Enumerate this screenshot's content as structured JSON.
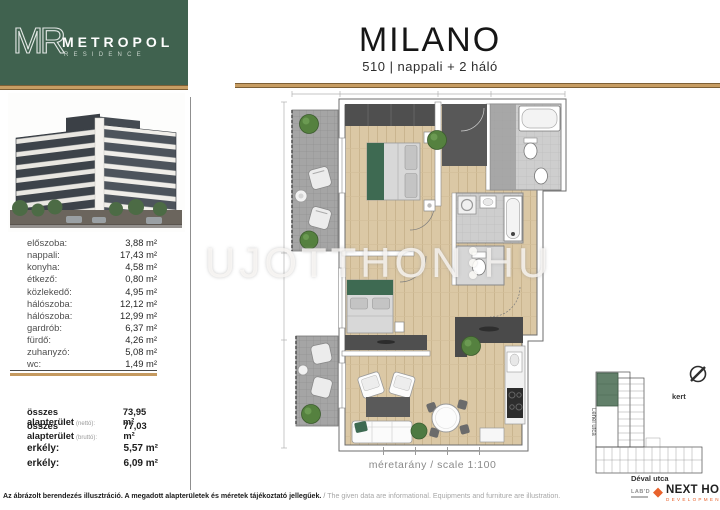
{
  "brand": {
    "monogram": "MR",
    "name": "METROPOL",
    "subname": "RESIDENCE"
  },
  "header": {
    "title": "MILANO",
    "subtitle": "510 | nappali + 2 háló"
  },
  "unit": {
    "rooms": [
      {
        "label": "előszoba:",
        "area": "3,88 m²"
      },
      {
        "label": "nappali:",
        "area": "17,43 m²"
      },
      {
        "label": "konyha:",
        "area": "4,58 m²"
      },
      {
        "label": "étkező:",
        "area": "0,80 m²"
      },
      {
        "label": "közlekedő:",
        "area": "4,95 m²"
      },
      {
        "label": "hálószoba:",
        "area": "12,12 m²"
      },
      {
        "label": "hálószoba:",
        "area": "12,99 m²"
      },
      {
        "label": "gardrób:",
        "area": "6,37 m²"
      },
      {
        "label": "fürdő:",
        "area": "4,26 m²"
      },
      {
        "label": "zuhanyzó:",
        "area": "5,08 m²"
      },
      {
        "label": "wc:",
        "area": "1,49 m²"
      }
    ],
    "totals": [
      {
        "label": "összes alapterület",
        "note": "(nettó):",
        "area": "73,95 m²"
      },
      {
        "label": "összes alapterület",
        "note": "(bruttó):",
        "area": "77,03 m²"
      }
    ],
    "balconies": [
      {
        "label": "erkély:",
        "area": "5,57 m²"
      },
      {
        "label": "erkély:",
        "area": "6,09 m²"
      }
    ]
  },
  "plan": {
    "scale_text": "méretarány / scale 1:100"
  },
  "watermark": {
    "left": "UJOTTHON",
    "right": "HU"
  },
  "siteplan": {
    "garden": "kert",
    "street_left": "Lehel utca",
    "street_bottom": "Déval utca"
  },
  "partners": {
    "lab": "LAB'D",
    "name": "NEXT HOME",
    "division": "DEVELOPMENT"
  },
  "footer": {
    "hu": "Az ábrázolt berendezés illusztráció. A megadott alapterületek és méretek tájékoztató jellegűek.",
    "divider": "/",
    "en": "The given data are informational. Equipments and furniture are illustration."
  },
  "colors": {
    "brand_green": "#40624f",
    "gold": "#c79d63",
    "wood": "#dbc8a5",
    "accent_orange": "#e8622c"
  }
}
